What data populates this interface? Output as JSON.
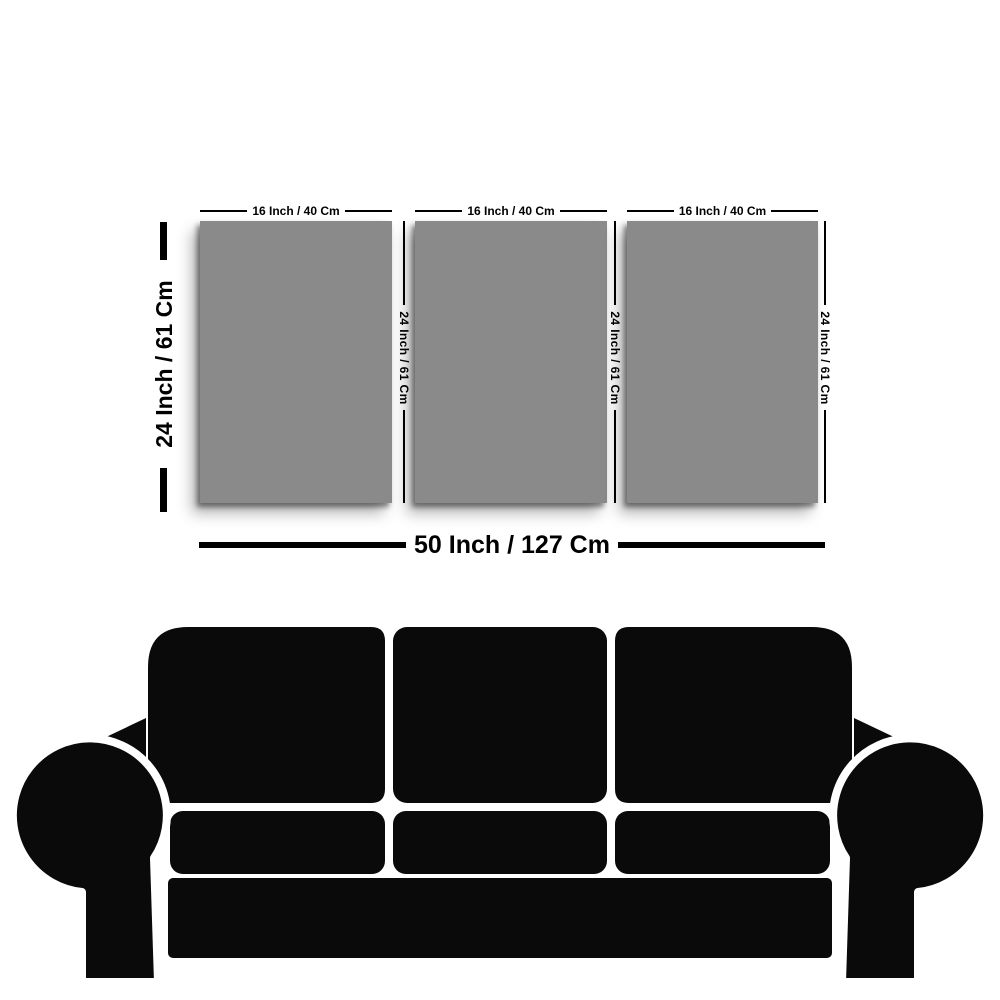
{
  "colors": {
    "background": "#ffffff",
    "panel": "#8a8a8a",
    "silhouette": "#0a0a0a",
    "text": "#000000"
  },
  "size_guide": {
    "panels": [
      {
        "width_label": "16 Inch / 40 Cm",
        "height_label": "24 Inch / 61 Cm"
      },
      {
        "width_label": "16 Inch / 40 Cm",
        "height_label": "24 Inch / 61 Cm"
      },
      {
        "width_label": "16 Inch / 40 Cm",
        "height_label": "24 Inch / 61 Cm"
      }
    ],
    "left_height_label": "24 Inch / 61 Cm",
    "total_width_label": "50 Inch / 127 Cm"
  },
  "icons": {
    "sofa": "sofa-silhouette"
  }
}
